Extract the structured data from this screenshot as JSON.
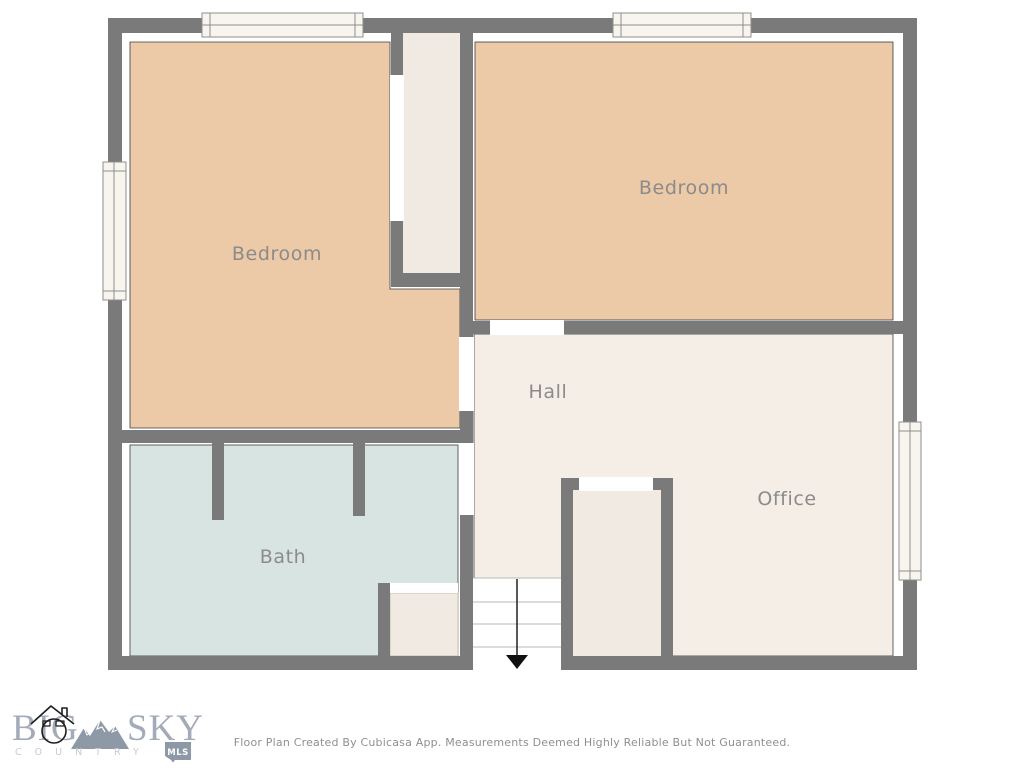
{
  "floor_plan": {
    "wall_color": "#7a7a7a",
    "room_outline_color": "#3c3c3c",
    "closet_fill": "#f1eae2",
    "label_color": "#8b8b8b",
    "rooms": [
      {
        "label": "Bedroom",
        "fill": "#ecc9a7"
      },
      {
        "label": "Bedroom",
        "fill": "#ecc9a7"
      },
      {
        "label": "Hall",
        "fill": "#f5eee7"
      },
      {
        "label": "Office",
        "fill": "#f5eee7"
      },
      {
        "label": "Bath",
        "fill": "#d8e4e2"
      }
    ],
    "stairs": {
      "treads": 4,
      "direction": "down"
    }
  },
  "footer": {
    "logo": {
      "word_big": "BIG",
      "word_sky": "SKY",
      "word_country": "COUNTRY",
      "badge_label": "MLS",
      "letter_color": "#a3abb9",
      "accent_color": "#8e99a8"
    },
    "disclaimer": "Floor Plan Created By Cubicasa App. Measurements Deemed Highly Reliable But Not Guaranteed."
  }
}
